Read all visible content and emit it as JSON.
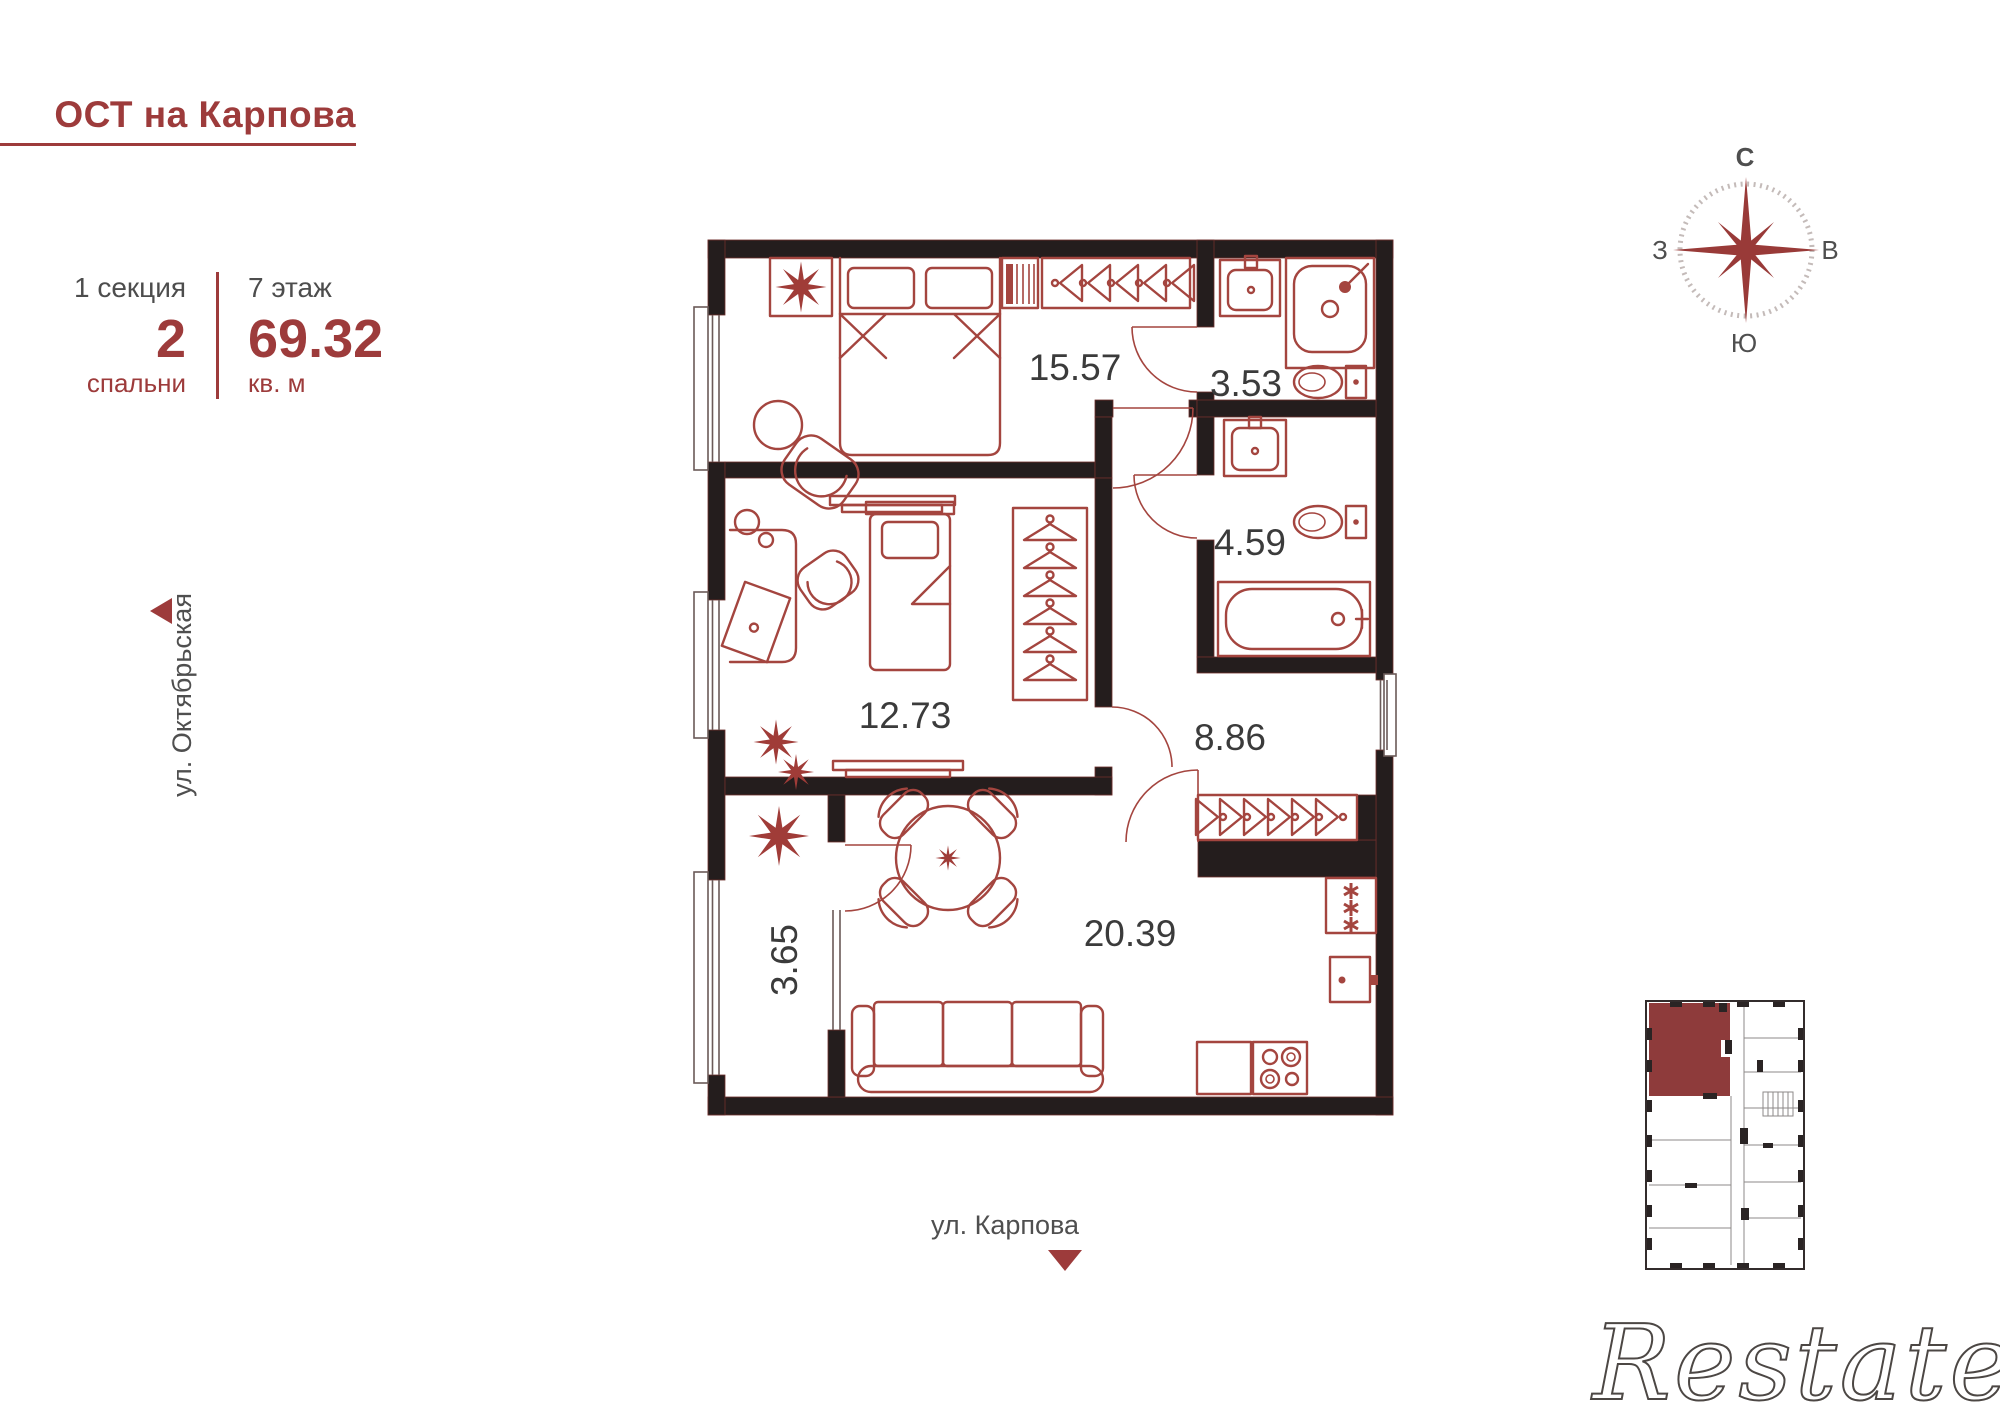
{
  "header": {
    "title": "ОСТ на Карпова"
  },
  "unit": {
    "section": "1 секция",
    "bedrooms_count": "2",
    "bedrooms_label": "спальни",
    "floor": "7 этаж",
    "area": "69.32",
    "area_unit": "кв. м"
  },
  "streets": {
    "left": "ул. Октябрьская",
    "bottom": "ул. Карпова"
  },
  "compass": {
    "north": "С",
    "east": "В",
    "south": "Ю",
    "west": "З"
  },
  "floor_plan": {
    "rooms": [
      {
        "id": "bedroom-1",
        "area": "15.57"
      },
      {
        "id": "bathroom-1",
        "area": "3.53"
      },
      {
        "id": "bathroom-2",
        "area": "4.59"
      },
      {
        "id": "bedroom-2",
        "area": "12.73"
      },
      {
        "id": "hallway",
        "area": "8.86"
      },
      {
        "id": "living-kitchen",
        "area": "20.39"
      },
      {
        "id": "balcony",
        "area": "3.65"
      }
    ]
  },
  "watermark": "Restate",
  "colors": {
    "accent": "#9d3b3b",
    "furniture_line": "#a4453f",
    "wall": "#241d1d",
    "room_label": "#3b3b3b",
    "street_label": "#4f4f4f",
    "mini_plan_highlight": "#8e3b3b"
  }
}
